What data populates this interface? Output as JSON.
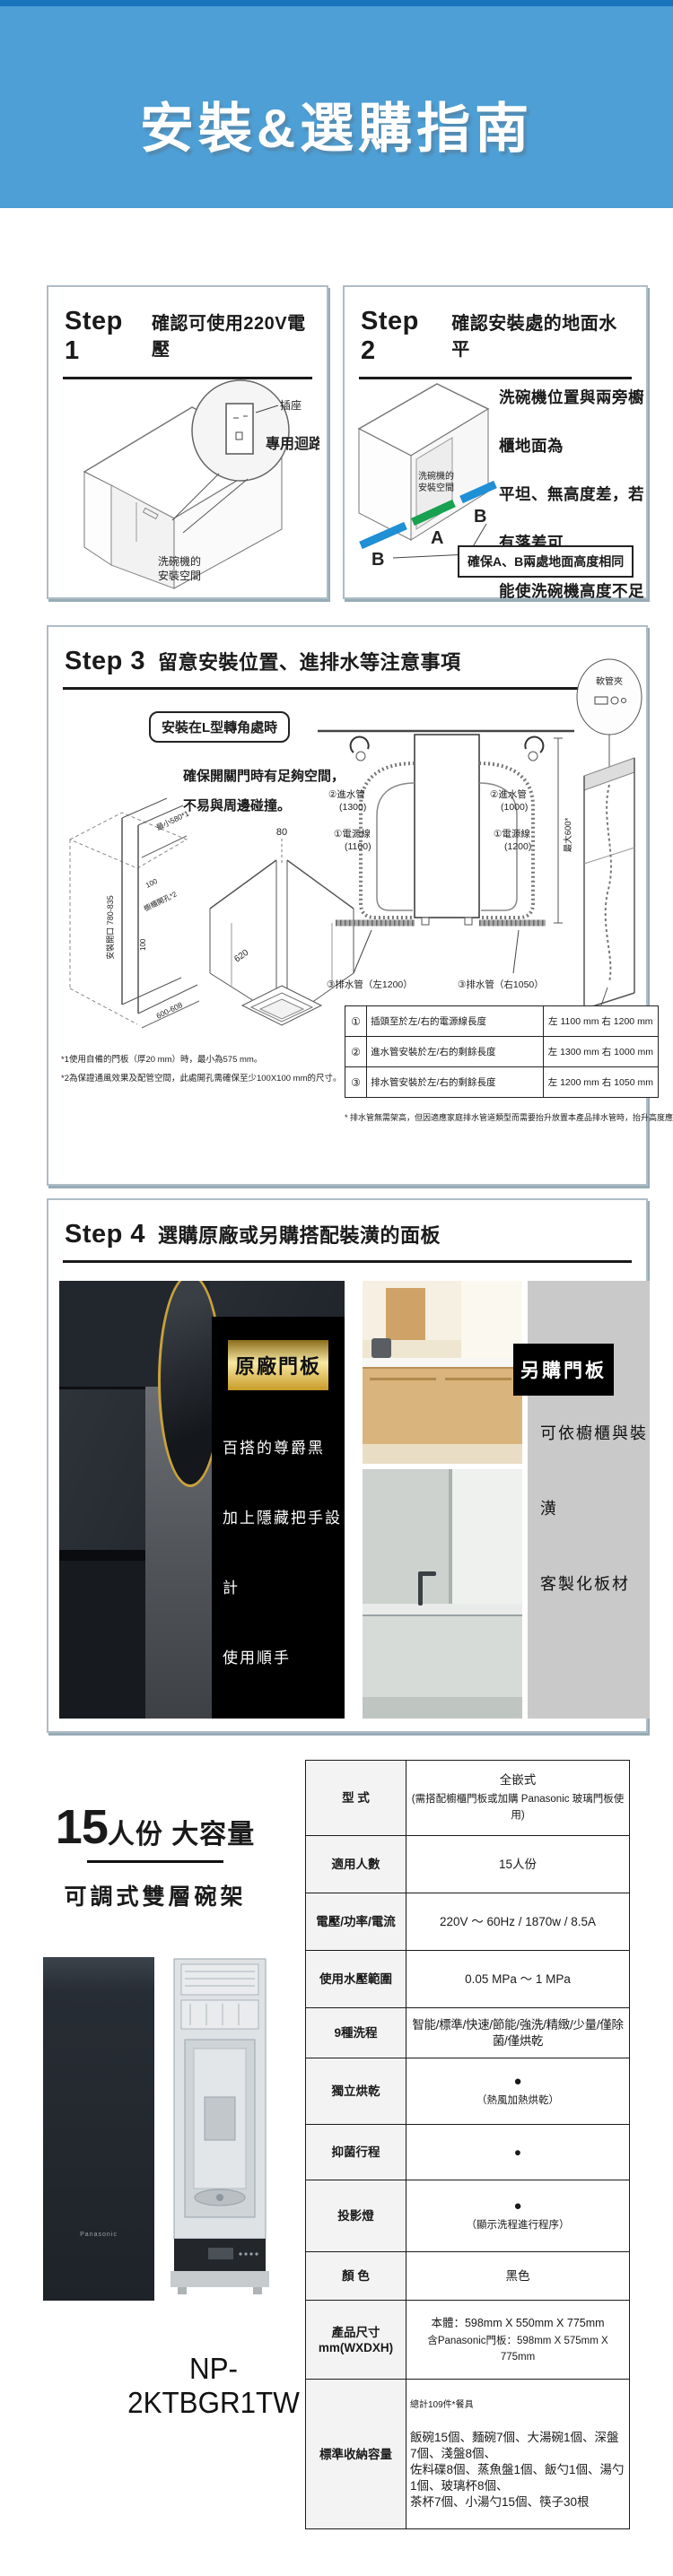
{
  "banner": {
    "title": "安裝&選購指南"
  },
  "steps": {
    "s1": {
      "label": "Step 1",
      "title": "確認可使用220V電壓",
      "outlet": "插座",
      "circuit": "專用迴路",
      "space1": "洗碗機的",
      "space2": "安裝空間"
    },
    "s2": {
      "label": "Step 2",
      "title": "確認安裝處的地面水平",
      "desc": "洗碗機位置與兩旁櫥櫃地面為\n平坦、無高度差，若有落差可\n能使洗碗機高度不足無法安裝",
      "space1": "洗碗機的",
      "space2": "安裝空間",
      "a": "A",
      "b": "B",
      "callout": "確保A、B兩處地面高度相同"
    },
    "s3": {
      "label": "Step 3",
      "title": "留意安裝位置、進排水等注意事項",
      "corner_tag": "安裝在L型轉角處時",
      "corner_desc": "確保開關門時有足夠空間，\n不易與周邊碰撞。",
      "dim_opening": "安裝開口 780-835",
      "dim_min": "最小580*1",
      "dim_100a": "100",
      "dim_hole": "櫥櫃開孔*2",
      "dim_100b": "100",
      "dim_width": "600-608",
      "dim_80": "80",
      "dim_620": "620",
      "in_l1": "②進水管",
      "in_l2": "(1300)",
      "pw_l1": "①電源線",
      "pw_l2": "(1100)",
      "dr_l": "③排水管（左1200）",
      "in_r1": "②進水管",
      "in_r2": "(1000)",
      "pw_r1": "①電源線",
      "pw_r2": "(1200)",
      "dr_r": "③排水管（右1050）",
      "max": "最大600*",
      "clip": "軟管夾",
      "hole_size": "開孔尺寸：100×100",
      "table": [
        {
          "num": "①",
          "label": "插頭至於左/右的電源線長度",
          "value": "左 1100 mm 右 1200 mm"
        },
        {
          "num": "②",
          "label": "進水管安裝於左/右的剩餘長度",
          "value": "左 1300 mm 右 1000 mm"
        },
        {
          "num": "③",
          "label": "排水管安裝於左/右的剩餘長度",
          "value": "左 1200 mm 右 1050 mm"
        }
      ],
      "note1": "*1使用自備的門板（厚20 mm）時，最小為575 mm。",
      "note2": "*2為保證通風效果及配管空間，此處開孔需確保至少100X100 mm的尺寸。",
      "note3": "* 排水管無需架高，但因適應家庭排水管道類型而需要抬升放置本產品排水管時，抬升高度應低於600mm。"
    },
    "s4": {
      "label": "Step 4",
      "title": "選購原廠或另購搭配裝潢的面板",
      "original_badge": "原廠門板",
      "original_lines": "百搭的尊爵黑\n加上隱藏把手設計\n使用順手\n完美融入櫥櫃",
      "optional_badge": "另購門板",
      "optional_lines": "可依櫥櫃與裝潢\n客製化板材"
    }
  },
  "bottom": {
    "headline_num": "15",
    "headline_rest": "人份 大容量",
    "subtitle": "可調式雙層碗架",
    "brand": "Panasonic",
    "model": "NP-2KTBGR1TW",
    "spec": [
      {
        "label": "型  式",
        "value": "全嵌式",
        "value2": "(需搭配櫥櫃門板或加購 Panasonic 玻璃門板使用)"
      },
      {
        "label": "適用人數",
        "value": "15人份"
      },
      {
        "label": "電壓/功率/電流",
        "value": "220V ～ 60Hz / 1870w / 8.5A"
      },
      {
        "label": "使用水壓範圍",
        "value": "0.05 MPa ～ 1 MPa"
      },
      {
        "label": "9種洗程",
        "value": "智能/標準/快速/節能/強洗/精緻/少量/僅除菌/僅烘乾"
      },
      {
        "label": "獨立烘乾",
        "value": "●",
        "value2": "（熱風加熱烘乾）"
      },
      {
        "label": "抑菌行程",
        "value": "●"
      },
      {
        "label": "投影燈",
        "value": "●",
        "value2": "（顯示洗程進行程序）"
      },
      {
        "label": "顏  色",
        "value": "黑色"
      },
      {
        "label": "產品尺寸\nmm(WXDXH)",
        "value": "本體：598mm X 550mm X 775mm",
        "value2": "含Panasonic門板：598mm X 575mm X 775mm"
      },
      {
        "label": "標準收納容量",
        "value": "總計109件*餐具",
        "value2": "飯碗15個、麵碗7個、大湯碗1個、深盤7個、淺盤8個、\n佐料碟8個、蒸魚盤1個、飯勺1個、湯勺1個、玻璃杯8個、\n茶杯7個、小湯勺15個、筷子30根"
      }
    ]
  }
}
